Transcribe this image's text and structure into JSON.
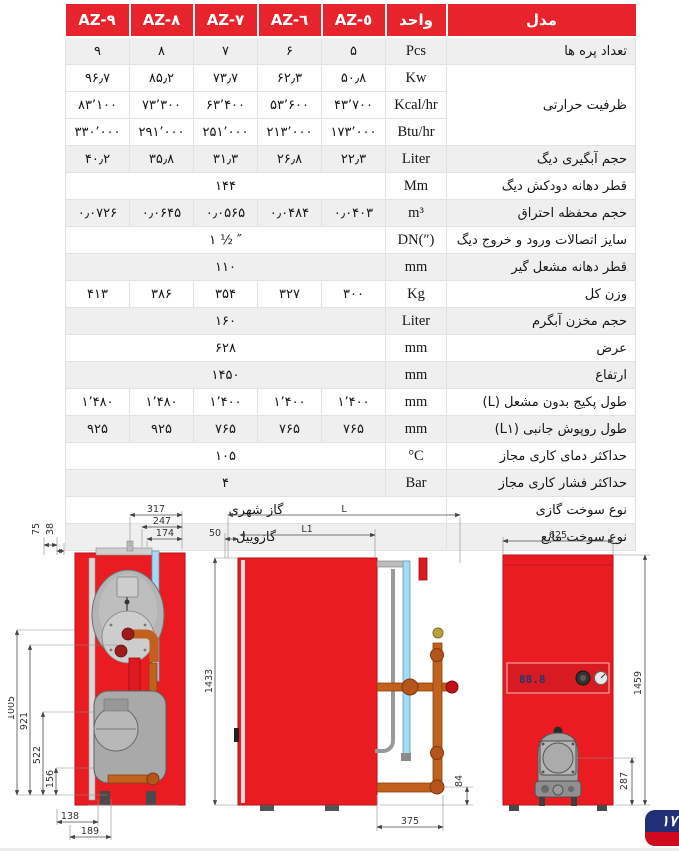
{
  "page": {
    "badge_number": "۱۷"
  },
  "colors": {
    "header_red": "#e7232b",
    "drawing_red": "#ea1c22",
    "row_shade": "#efefef",
    "badge_navy": "#222f77",
    "badge_red": "#cf0a1f"
  },
  "table": {
    "columns": [
      "AZ-٩",
      "AZ-٨",
      "AZ-٧",
      "AZ-٦",
      "AZ-٥",
      "واحد",
      "مدل"
    ],
    "rows": [
      {
        "label": "تعداد پره ها",
        "unit": "Pcs",
        "type": "values",
        "shade": true,
        "values": [
          "۹",
          "۸",
          "۷",
          "۶",
          "۵"
        ]
      },
      {
        "label": "ظرفیت حرارتی",
        "labelRowspan": 3,
        "unit": "Kw",
        "type": "values",
        "shade": false,
        "values": [
          "۹۶٫۷",
          "۸۵٫۲",
          "۷۳٫۷",
          "۶۲٫۳",
          "۵۰٫۸"
        ]
      },
      {
        "unit": "Kcal/hr",
        "type": "values",
        "shade": false,
        "values": [
          "۸۳٬۱۰۰",
          "۷۳٬۳۰۰",
          "۶۳٬۴۰۰",
          "۵۳٬۶۰۰",
          "۴۳٬۷۰۰"
        ]
      },
      {
        "unit": "Btu/hr",
        "type": "values",
        "shade": false,
        "values": [
          "۳۳۰٬۰۰۰",
          "۲۹۱٬۰۰۰",
          "۲۵۱٬۰۰۰",
          "۲۱۳٬۰۰۰",
          "۱۷۳٬۰۰۰"
        ]
      },
      {
        "label": "حجم آبگیری دیگ",
        "unit": "Liter",
        "type": "values",
        "shade": true,
        "values": [
          "۴۰٫۲",
          "۳۵٫۸",
          "۳۱٫۳",
          "۲۶٫۸",
          "۲۲٫۳"
        ]
      },
      {
        "label": "قطر دهانه دودکش دیگ",
        "unit": "Mm",
        "type": "merged",
        "shade": false,
        "value": "۱۴۴"
      },
      {
        "label": "حجم محفظه احتراق",
        "unit": "m³",
        "type": "values",
        "shade": true,
        "values": [
          "۰٫۰۷۲۶",
          "۰٫۰۶۴۵",
          "۰٫۰۵۶۵",
          "۰٫۰۴۸۴",
          "۰٫۰۴۰۳"
        ]
      },
      {
        "label": "سایز اتصالات ورود و خروج دیگ",
        "unit": "DN(″)",
        "type": "merged",
        "shade": false,
        "value": "۱ ½ ″"
      },
      {
        "label": "قطر دهانه مشعل گیر",
        "unit": "mm",
        "type": "merged",
        "shade": true,
        "value": "۱۱۰"
      },
      {
        "label": "وزن کل",
        "unit": "Kg",
        "type": "values",
        "shade": false,
        "values": [
          "۴۱۳",
          "۳۸۶",
          "۳۵۴",
          "۳۲۷",
          "۳۰۰"
        ]
      },
      {
        "label": "حجم مخزن آبگرم",
        "unit": "Liter",
        "type": "merged",
        "shade": true,
        "value": "۱۶۰"
      },
      {
        "label": "عرض",
        "unit": "mm",
        "type": "merged",
        "shade": false,
        "value": "۶۲۸"
      },
      {
        "label": "ارتفاع",
        "unit": "mm",
        "type": "merged",
        "shade": true,
        "value": "۱۴۵۰"
      },
      {
        "label": "طول پکیج بدون مشعل (L)",
        "unit": "mm",
        "type": "values",
        "shade": false,
        "values": [
          "۱٬۴۸۰",
          "۱٬۴۸۰",
          "۱٬۴۰۰",
          "۱٬۴۰۰",
          "۱٬۴۰۰"
        ]
      },
      {
        "label": "طول روپوش جانبی (L۱)",
        "unit": "mm",
        "type": "values",
        "shade": true,
        "values": [
          "۹۲۵",
          "۹۲۵",
          "۷۶۵",
          "۷۶۵",
          "۷۶۵"
        ]
      },
      {
        "label": "حداکثر دمای کاری مجاز",
        "unit": "°C",
        "type": "merged",
        "shade": false,
        "value": "۱۰۵"
      },
      {
        "label": "حداکثر فشار کاری مجاز",
        "unit": "Bar",
        "type": "merged",
        "shade": true,
        "value": "۴"
      },
      {
        "label": "نوع سوخت گازی",
        "type": "full",
        "shade": false,
        "value": "گاز شهری"
      },
      {
        "label": "نوع سوخت مایع",
        "type": "full",
        "shade": true,
        "value": "گازوییل"
      }
    ]
  },
  "drawings": {
    "left": {
      "top_dims": [
        "317",
        "247",
        "174"
      ],
      "top_left_dims": [
        "75",
        "38"
      ],
      "side_dims": [
        "1005",
        "921",
        "522",
        "156"
      ],
      "bottom_dims": [
        "138",
        "189"
      ]
    },
    "middle": {
      "length_label": "L",
      "cover_label": "L1",
      "offset_label": "50",
      "height_label": "1433",
      "bottom_label": "375",
      "pipe_height_label": "84"
    },
    "right": {
      "width_label": "625",
      "height_label": "1459",
      "burner_height_label": "287",
      "display_text": "88.8"
    }
  }
}
